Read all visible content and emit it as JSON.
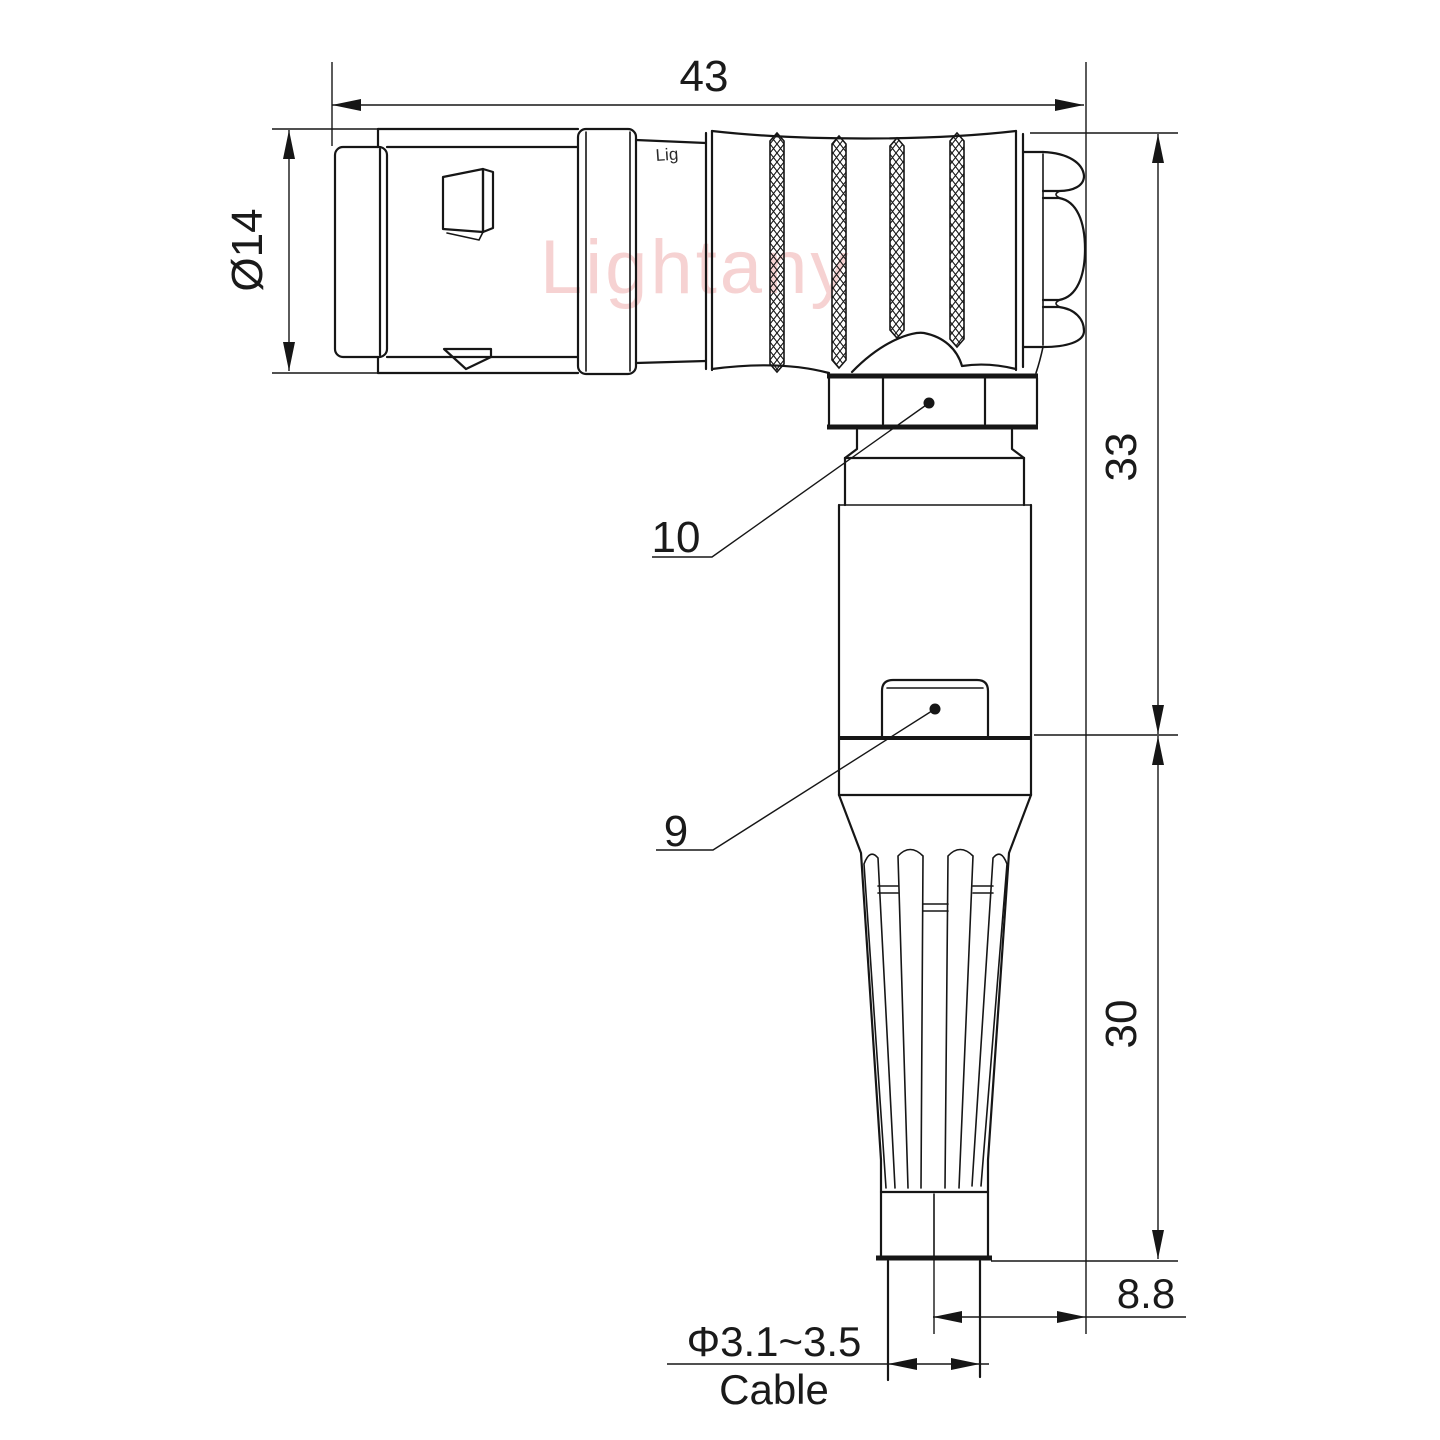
{
  "drawing": {
    "watermark": "Lightany",
    "part_logo": "Lig",
    "dimensions": {
      "overall_length": "43",
      "front_diameter": "Ø14",
      "upper_height": "33",
      "lower_height": "30",
      "back_offset": "8.8",
      "cable_diameter": "Φ3.1~3.5",
      "cable_label": "Cable"
    },
    "callouts": {
      "coupling_nut": "10",
      "body_item": "9"
    },
    "colors": {
      "line": "#161616",
      "watermark_pink": "#eda5a5",
      "background": "#ffffff"
    }
  }
}
